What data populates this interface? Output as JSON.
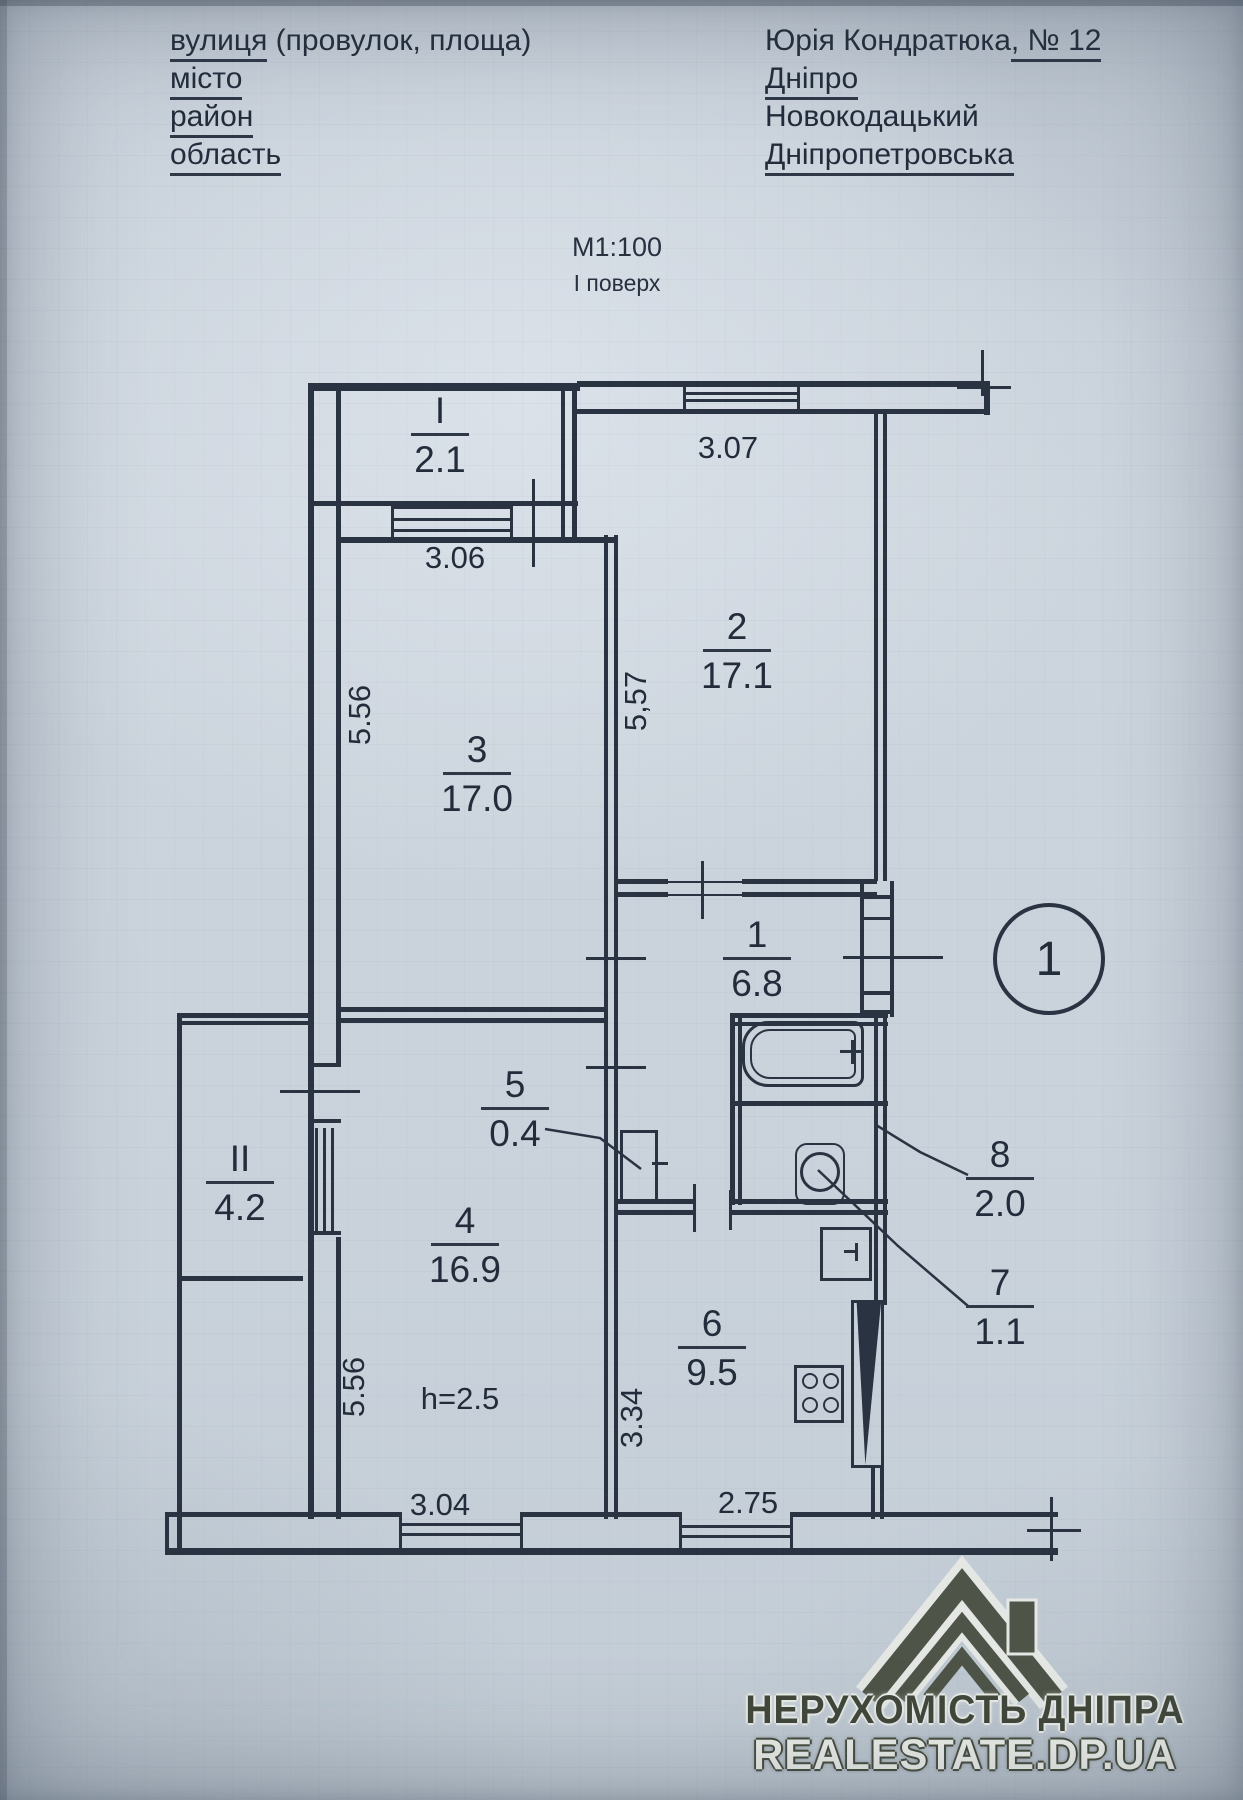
{
  "header": {
    "f1": "вулиця",
    "f1b": " (провулок, площа)",
    "v1a": "Юрія Кондратюка",
    "v1b": ", № 12",
    "f2": "місто",
    "v2": "Дніпро",
    "f3": "район",
    "v3": "Новокодацький",
    "f4": "область",
    "v4": "Дніпропетровська",
    "scale": "М1:100",
    "floor": "І поверх"
  },
  "plan": {
    "marker": "1",
    "rooms": [
      {
        "num": "1",
        "area": "6.8"
      },
      {
        "num": "2",
        "area": "17.1"
      },
      {
        "num": "3",
        "area": "17.0"
      },
      {
        "num": "4",
        "area": "16.9"
      },
      {
        "num": "5",
        "area": "0.4"
      },
      {
        "num": "6",
        "area": "9.5"
      },
      {
        "num": "7",
        "area": "1.1"
      },
      {
        "num": "8",
        "area": "2.0"
      },
      {
        "num": "І",
        "area": "2.1"
      },
      {
        "num": "ІІ",
        "area": "4.2"
      }
    ],
    "dims": {
      "w2": "3.07",
      "w3": "3.06",
      "h3": "5.56",
      "h2": "5,57",
      "h4": "5.56",
      "h6": "3.34",
      "w4": "3.04",
      "w6": "2.75",
      "note": "h=2.5"
    }
  },
  "watermark": {
    "line1": "НЕРУХОМІСТЬ ДНІПРА",
    "line2": "REALESTATE.DP.UA"
  }
}
